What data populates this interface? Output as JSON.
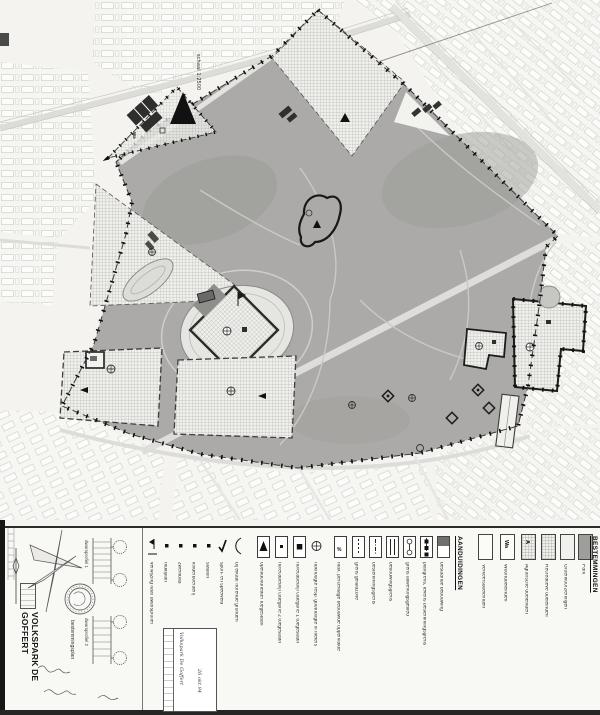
{
  "colors": {
    "paper": "#f4f3f0",
    "park_gray": "#abaaa8",
    "ink": "#1b1b1b",
    "checker": "#eeeeea"
  },
  "map": {
    "scale_label": "schaal 1:2500",
    "parcel_code": "Wa"
  },
  "legend": {
    "bestemmingen_heading": "BESTEMMINGEN",
    "aanduidingen_heading": "AANDUIDINGEN",
    "bestemmingen": [
      {
        "label": "Park"
      },
      {
        "label": "Groenvoorzieningen"
      },
      {
        "label": "Recreatieve doeleinden"
      },
      {
        "label": "Agrarische doeleinden",
        "code": "A"
      },
      {
        "label": "Woondoeleinden",
        "code": "Wa"
      },
      {
        "label": "Verkeersdoeleinden"
      }
    ],
    "aanduidingen": [
      {
        "label": "bestaande bebouwing"
      },
      {
        "label": "plangrens, tevens bestemmingsgrens"
      },
      {
        "label": "grens uitwerkingsgebied"
      },
      {
        "label": "bebouwingsgrens"
      },
      {
        "label": "bestemmingsgrens"
      },
      {
        "label": "grens geluidzone"
      },
      {
        "label": "max. percentage bebouwde oppervlakte",
        "symbol_text": "%"
      },
      {
        "label": "nokhoogte resp. goothoogte in meters"
      },
      {
        "label": "horecabedrijf categorie 1 toegestaan"
      },
      {
        "label": "horecabedrijf categorie 2 toegestaan"
      },
      {
        "label": "openluchttheater toegestaan"
      },
      {
        "label": "bij elkaar horende gronden"
      },
      {
        "label": "sport- en speelveld"
      },
      {
        "label": "stadion"
      },
      {
        "label": "kinderboerderij"
      },
      {
        "label": "zwembad"
      },
      {
        "label": "multiplan"
      },
      {
        "label": "verwijzing naar dwarsprofiel"
      }
    ]
  },
  "title_block": {
    "plan_type": "bestemmingsplan",
    "title": "VOLKSPARK DE GOFFERT",
    "profile_1": "dwarsprofiel 1",
    "profile_2": "dwarsprofiel 2",
    "stamp_line_1": "Volkspark De Goffert",
    "stamp_line_2": "26 okt 94"
  }
}
